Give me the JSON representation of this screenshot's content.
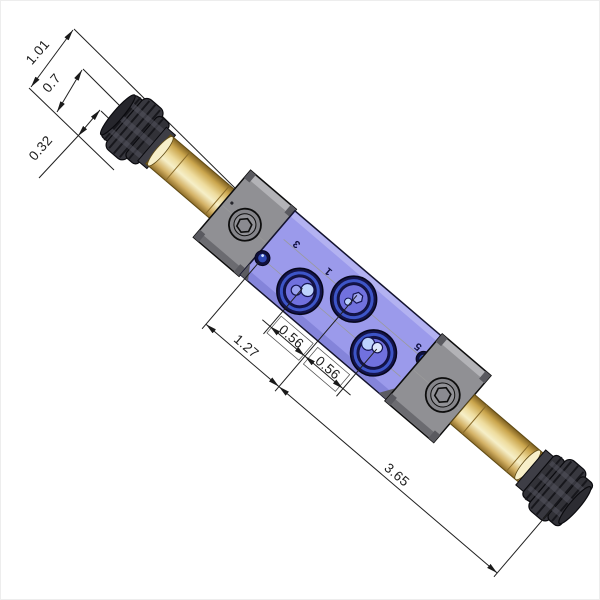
{
  "drawing": {
    "title": "valve-assembly-isometric-drawing",
    "dimensions": {
      "knob_stack_a": "1.01",
      "knob_stack_b": "0.7",
      "knob_stack_c": "0.32",
      "port_offset": "1.27",
      "port_spacing_1": "0.56",
      "port_spacing_2": "0.56",
      "overall_length": "3.65"
    },
    "port_labels": {
      "port_3": "3",
      "port_1": "1",
      "port_5": "5"
    },
    "colors": {
      "bg": "#ffffff",
      "line": "#1f1f1f",
      "body-purple": "#9b9aeb",
      "body-purple-dark": "#8282d8",
      "body-purple-light": "#b9b8f3",
      "block-gray": "#909094",
      "block-gray-light": "#b3b3b7",
      "block-gray-dark": "#6b6b70",
      "brass-light": "#f7efc9",
      "brass-mid": "#e9d494",
      "brass-dark": "#8a6a28",
      "knob": "#323238",
      "knob-light": "#54545e",
      "port-ring": "#14144a",
      "port-blue": "#3d55c8",
      "port-inner": "#7171de",
      "port-dot-light": "#bdd3fd",
      "centerline": "#9a9a9a"
    }
  }
}
